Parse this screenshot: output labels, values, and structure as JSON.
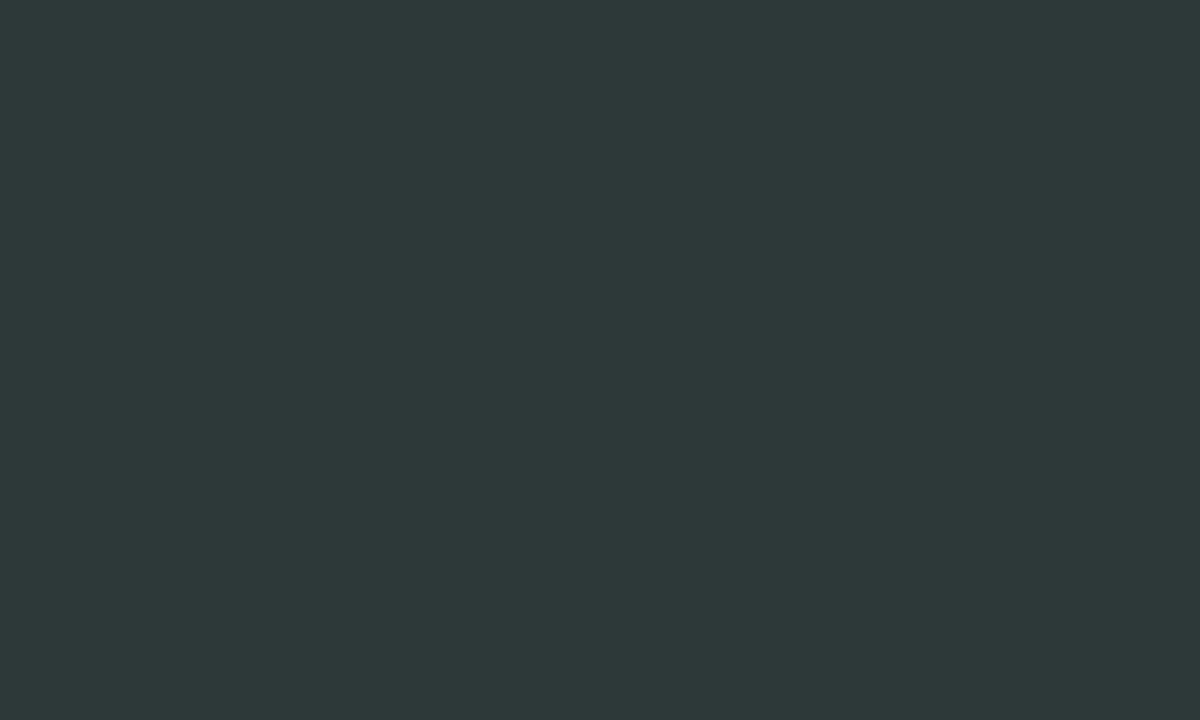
{
  "app": {
    "view_label": "satellite"
  },
  "map": {
    "marker_style": {
      "fill": "#7fd4f4",
      "ring": "#102530",
      "text_color": "#102530",
      "diameter_px": 28
    },
    "markers": [
      {
        "letter": "M",
        "x": 613,
        "y": 80
      },
      {
        "letter": "M",
        "x": 537,
        "y": 271
      },
      {
        "letter": "Y",
        "x": 527,
        "y": 293
      },
      {
        "letter": "M",
        "x": 491,
        "y": 295
      },
      {
        "letter": "S",
        "x": 475,
        "y": 301
      },
      {
        "letter": "M",
        "x": 444,
        "y": 310
      },
      {
        "letter": "S",
        "x": 459,
        "y": 322
      },
      {
        "letter": "M",
        "x": 547,
        "y": 332
      },
      {
        "letter": "M",
        "x": 458,
        "y": 339
      },
      {
        "letter": "S",
        "x": 493,
        "y": 344
      },
      {
        "letter": "M",
        "x": 476,
        "y": 346
      },
      {
        "letter": "S",
        "x": 443,
        "y": 352
      },
      {
        "letter": "M",
        "x": 467,
        "y": 356
      },
      {
        "letter": "M",
        "x": 455,
        "y": 363
      },
      {
        "letter": "S",
        "x": 511,
        "y": 364
      },
      {
        "letter": "M",
        "x": 482,
        "y": 372
      },
      {
        "letter": "M",
        "x": 452,
        "y": 375
      },
      {
        "letter": "S",
        "x": 593,
        "y": 377
      },
      {
        "letter": "Y",
        "x": 456,
        "y": 391
      },
      {
        "letter": "S",
        "x": 532,
        "y": 393
      },
      {
        "letter": "S",
        "x": 566,
        "y": 396
      },
      {
        "letter": "Y",
        "x": 470,
        "y": 401
      },
      {
        "letter": "M",
        "x": 583,
        "y": 404
      },
      {
        "letter": "M",
        "x": 445,
        "y": 408
      },
      {
        "letter": "Y",
        "x": 478,
        "y": 414
      },
      {
        "letter": "Y",
        "x": 500,
        "y": 415
      },
      {
        "letter": "S",
        "x": 565,
        "y": 421
      },
      {
        "letter": "S",
        "x": 626,
        "y": 423
      },
      {
        "letter": "S",
        "x": 592,
        "y": 425
      },
      {
        "letter": "S",
        "x": 524,
        "y": 428
      },
      {
        "letter": "Y",
        "x": 488,
        "y": 429
      },
      {
        "letter": "S",
        "x": 548,
        "y": 434
      },
      {
        "letter": "S",
        "x": 613,
        "y": 443
      },
      {
        "letter": "Y",
        "x": 510,
        "y": 444
      },
      {
        "letter": "S",
        "x": 561,
        "y": 447
      },
      {
        "letter": "S",
        "x": 637,
        "y": 448
      },
      {
        "letter": "S",
        "x": 582,
        "y": 449
      },
      {
        "letter": "S",
        "x": 497,
        "y": 452
      },
      {
        "letter": "S",
        "x": 548,
        "y": 458
      },
      {
        "letter": "W",
        "x": 660,
        "y": 459
      },
      {
        "letter": "M",
        "x": 622,
        "y": 461
      },
      {
        "letter": "S",
        "x": 595,
        "y": 467
      },
      {
        "letter": "M",
        "x": 640,
        "y": 468
      },
      {
        "letter": "S",
        "x": 571,
        "y": 474
      },
      {
        "letter": "S",
        "x": 605,
        "y": 478
      },
      {
        "letter": "M",
        "x": 585,
        "y": 479
      }
    ]
  },
  "palette": {
    "water": "#42504b",
    "water_channel": "#3c4a46",
    "tarmac": "#b5b2aa",
    "concrete": "#c1beb4",
    "dark_roof": "#3b3f45",
    "vegetation": "#3c5733",
    "solar_panel": "#2e4d7d",
    "sand": "#e3d9bf"
  }
}
